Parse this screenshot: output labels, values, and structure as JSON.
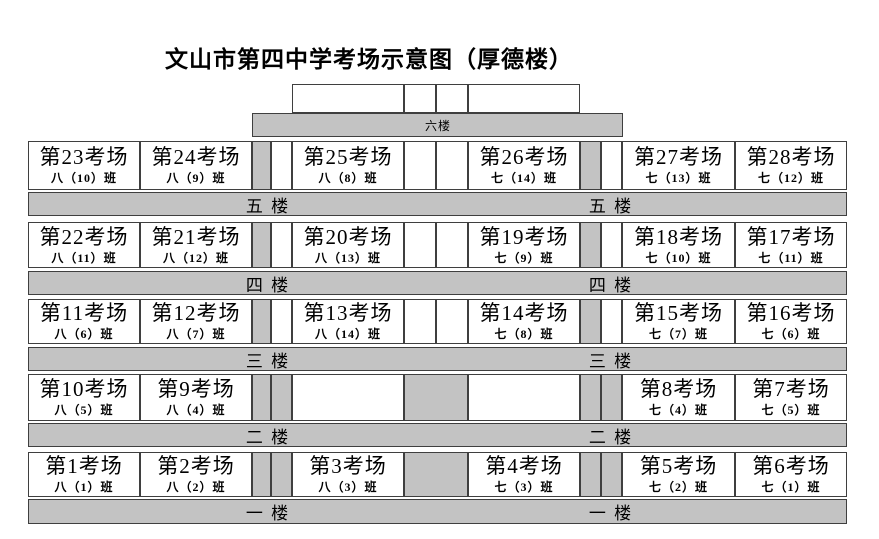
{
  "title": "文山市第四中学考场示意图（厚德楼）",
  "top_floor": {
    "bar_label": "六楼",
    "rooms": [
      "",
      "",
      "",
      ""
    ]
  },
  "floors": [
    {
      "bar_label": "五 楼",
      "rooms": [
        {
          "name": "第23考场",
          "cls": "八（10）班"
        },
        {
          "name": "第24考场",
          "cls": "八（9）班"
        },
        {
          "name": "第25考场",
          "cls": "八（8）班"
        },
        {
          "name": "第26考场",
          "cls": "七（14）班"
        },
        {
          "name": "第27考场",
          "cls": "七（13）班"
        },
        {
          "name": "第28考场",
          "cls": "七（12）班"
        }
      ]
    },
    {
      "bar_label": "四 楼",
      "rooms": [
        {
          "name": "第22考场",
          "cls": "八（11）班"
        },
        {
          "name": "第21考场",
          "cls": "八（12）班"
        },
        {
          "name": "第20考场",
          "cls": "八（13）班"
        },
        {
          "name": "第19考场",
          "cls": "七（9）班"
        },
        {
          "name": "第18考场",
          "cls": "七（10）班"
        },
        {
          "name": "第17考场",
          "cls": "七（11）班"
        }
      ]
    },
    {
      "bar_label": "三 楼",
      "rooms": [
        {
          "name": "第11考场",
          "cls": "八（6）班"
        },
        {
          "name": "第12考场",
          "cls": "八（7）班"
        },
        {
          "name": "第13考场",
          "cls": "八（14）班"
        },
        {
          "name": "第14考场",
          "cls": "七（8）班"
        },
        {
          "name": "第15考场",
          "cls": "七（7）班"
        },
        {
          "name": "第16考场",
          "cls": "七（6）班"
        }
      ]
    },
    {
      "bar_label": "二 楼",
      "rooms": [
        {
          "name": "第10考场",
          "cls": "八（5）班"
        },
        {
          "name": "第9考场",
          "cls": "八（4）班"
        },
        {
          "name": "",
          "cls": ""
        },
        {
          "name": "",
          "cls": ""
        },
        {
          "name": "第8考场",
          "cls": "七（4）班"
        },
        {
          "name": "第7考场",
          "cls": "七（5）班"
        }
      ]
    },
    {
      "bar_label": "一 楼",
      "rooms": [
        {
          "name": "第1考场",
          "cls": "八（1）班"
        },
        {
          "name": "第2考场",
          "cls": "八（2）班"
        },
        {
          "name": "第3考场",
          "cls": "八（3）班"
        },
        {
          "name": "第4考场",
          "cls": "七（3）班"
        },
        {
          "name": "第5考场",
          "cls": "七（2）班"
        },
        {
          "name": "第6考场",
          "cls": "七（1）班"
        }
      ]
    }
  ],
  "colors": {
    "slab_gray": "#c3c3c3",
    "border": "#3f3f3f",
    "room_bg": "#ffffff",
    "text": "#000000"
  }
}
